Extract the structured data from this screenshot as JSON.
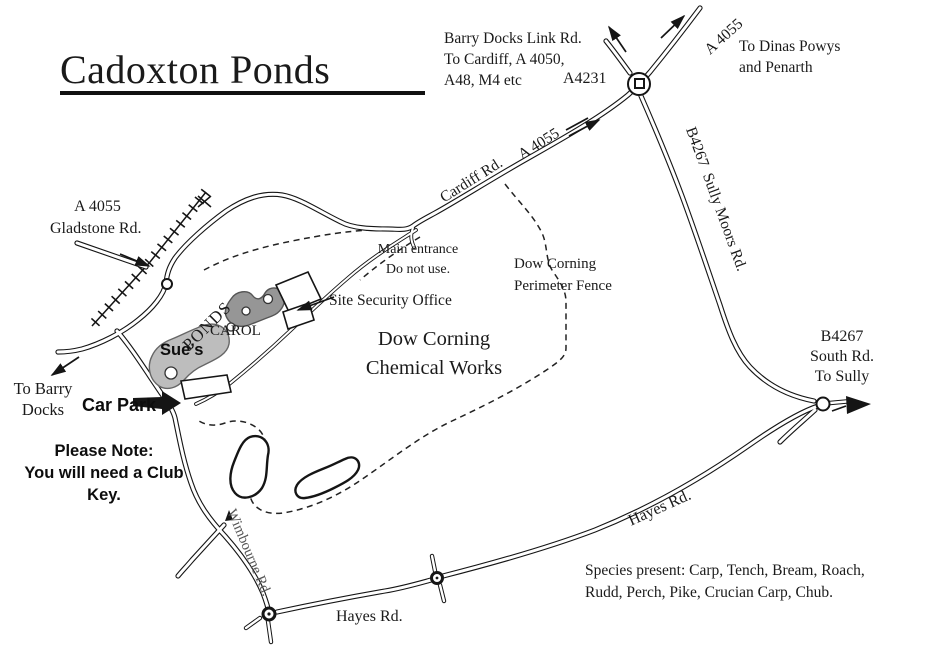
{
  "map": {
    "title": "Cadoxton Ponds",
    "labels": {
      "barry_docks_note": "Barry Docks Link Rd.\nTo Cardiff, A 4050,\nA48, M4 etc",
      "a4231": "A4231",
      "a4055_ne": "A 4055",
      "dinas_powys": "To Dinas Powys\nand Penarth",
      "a4055_cardiff": "A 4055",
      "cardiff_rd": "Cardiff Rd.",
      "b4267_sully_moors": "B4267  Sully Moors Rd.",
      "gladstone_a4055": "A 4055",
      "gladstone_rd": "Gladstone Rd.",
      "main_entrance": "Main entrance\nDo not use.",
      "dow_fence": "Dow Corning\nPerimeter Fence",
      "site_security": "Site Security Office",
      "dow_works": "Dow Corning\nChemical Works",
      "ponds": "PONDS",
      "carol": "CAROL",
      "sues": "Sue’s",
      "to_barry": "To Barry\nDocks",
      "car_park": "Car Park",
      "please_note": "Please Note:\nYou will need a Club\nKey.",
      "b4267_south": "B4267\nSouth Rd.\nTo Sully",
      "hayes_rd_ne": "Hayes Rd.",
      "hayes_rd_s": "Hayes Rd.",
      "wimbourne_rd": "Wimbourne Rd.",
      "species": "Species present: Carp, Tench, Bream, Roach,\nRudd, Perch, Pike, Crucian Carp, Chub."
    },
    "colors": {
      "ink": "#1a1a1a",
      "pond_sues": "#bdbdbd",
      "pond_carol": "#969696",
      "background": "#ffffff"
    }
  }
}
